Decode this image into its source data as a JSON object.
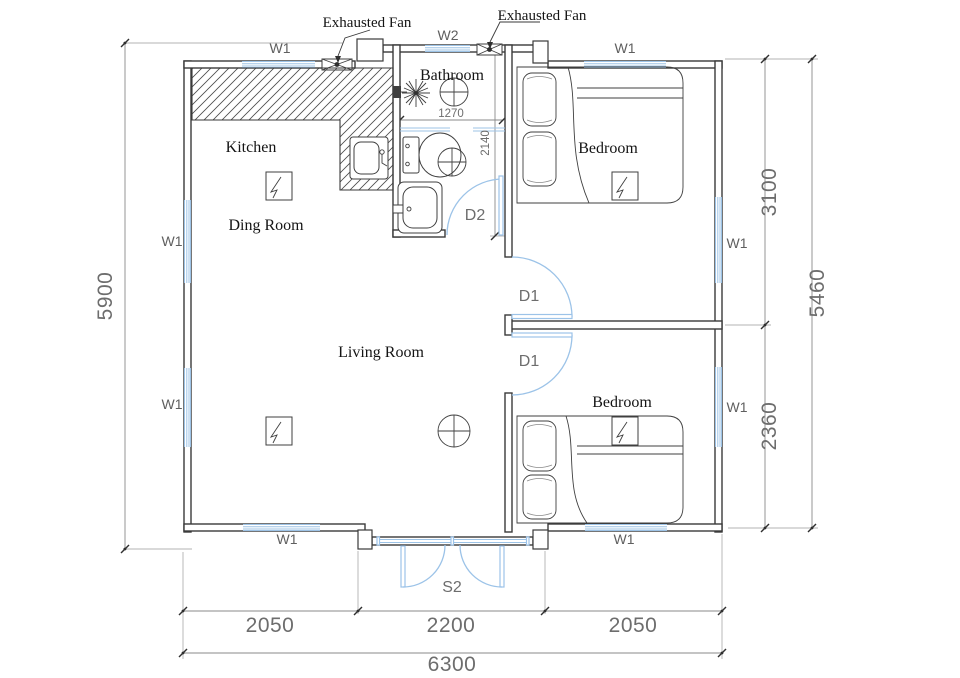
{
  "plan": {
    "annotations": {
      "exhausted_fan_left": "Exhausted Fan",
      "exhausted_fan_right": "Exhausted Fan"
    },
    "rooms": {
      "kitchen": "Kitchen",
      "dining": "Ding Room",
      "living": "Living Room",
      "bathroom": "Bathroom",
      "bedroom_top": "Bedroom",
      "bedroom_bottom": "Bedroom"
    },
    "windows": {
      "w1": "W1",
      "w2": "W2"
    },
    "doors": {
      "d1": "D1",
      "d2": "D2",
      "s2": "S2"
    },
    "dimensions": {
      "overall_width": "6300",
      "bottom_left": "2050",
      "bottom_center": "2200",
      "bottom_right": "2050",
      "left_height": "5900",
      "right_upper": "3100",
      "right_lower": "2360",
      "right_total": "5460",
      "bathroom_width": "1270",
      "bathroom_depth": "2140"
    },
    "colors": {
      "wall": "#3a3a3a",
      "window": "#9dc3e6",
      "door": "#9cc3e8",
      "dimension_text": "#6d6d6d",
      "label_text": "#141414",
      "background": "#ffffff"
    }
  }
}
